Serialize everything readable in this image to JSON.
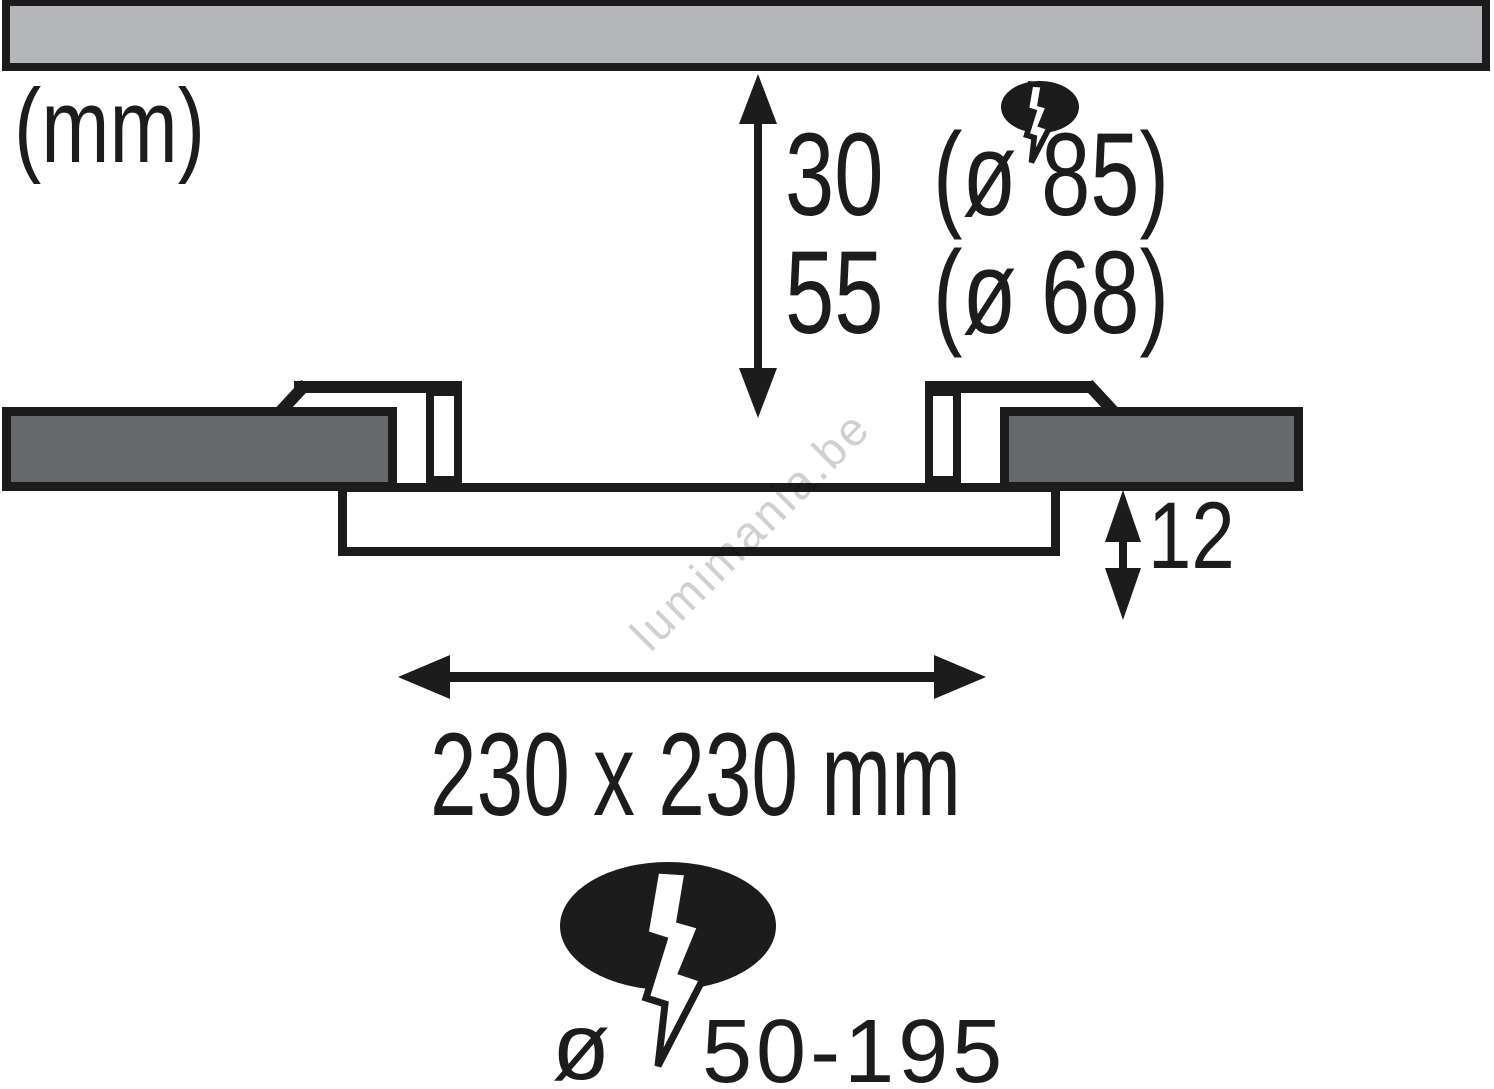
{
  "diagram": {
    "title_units": "(mm)",
    "depth_dimension": {
      "line1": {
        "value": "30",
        "diameter": "(ø 85)"
      },
      "line2": {
        "value": "55",
        "diameter": "(ø 68)"
      }
    },
    "panel_thickness": {
      "value": "12"
    },
    "cutout": {
      "label": "230 x 230 mm"
    },
    "cable_cutout": {
      "diameter_symbol": "ø",
      "value": "50-195"
    },
    "icons": {
      "top_symbol": "electric-connection-icon",
      "bottom_symbol": "electric-connection-icon"
    },
    "watermark": {
      "text": "lumimania.be"
    },
    "colors": {
      "line_black": "#1c1c1c",
      "ceiling_gray": "#b5b6ba",
      "flange_gray": "#67686c",
      "watermark_gray": "#d0d0d2"
    }
  }
}
